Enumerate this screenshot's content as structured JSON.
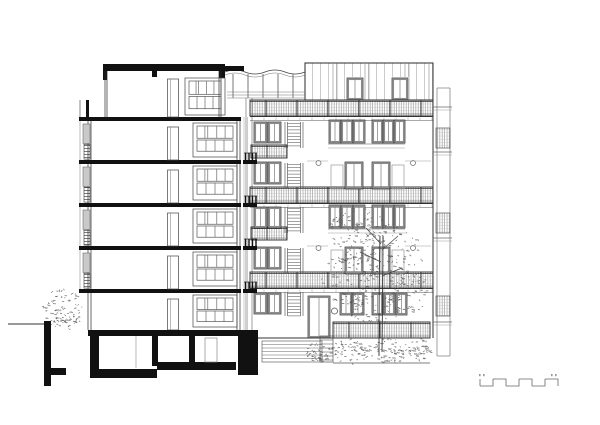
{
  "drawing": {
    "kind": "architectural section and elevation of multi-storey residential building",
    "colors": {
      "line": "#2a2a2a",
      "black": "#111111",
      "light": "#9a9a9a",
      "frame_gray": "#8c8c8c",
      "foliage": "#555555",
      "bg": "#ffffff"
    },
    "section": {
      "slab_x1": 79,
      "slab_x2": 241,
      "slab_h": 4,
      "floor_slabs_y": [
        117,
        160,
        203,
        246,
        289
      ],
      "interiors": [
        {
          "top": 121,
          "bottom": 160
        },
        {
          "top": 164,
          "bottom": 203
        },
        {
          "top": 207,
          "bottom": 246
        },
        {
          "top": 250,
          "bottom": 289
        },
        {
          "top": 293,
          "bottom": 330
        }
      ],
      "door": {
        "x": 167.5,
        "w": 11
      },
      "winwall": {
        "x": 193,
        "w": 44
      },
      "left_wall_x": [
        88,
        91
      ],
      "right_wall_x": [
        237,
        240
      ],
      "left_strip": {
        "panel_x": 83,
        "panel_w": 7,
        "louver_x": 84,
        "louver_w": 6
      },
      "roof": {
        "main": [
          103,
          64,
          121,
          7
        ],
        "left_drop": [
          103,
          64,
          4,
          16
        ],
        "right_drop": [
          219,
          64,
          6,
          14
        ],
        "beam": [
          224,
          66,
          20,
          5
        ],
        "mid_stub": [
          152,
          71,
          5,
          6
        ],
        "parapet": [
          86,
          100,
          3,
          17
        ]
      },
      "penthouse": {
        "wall_left": [
          105,
          107
        ],
        "wall_right": [
          219,
          221
        ],
        "top": 71,
        "floor": 117,
        "door": {
          "x": 167.5,
          "y": 79,
          "w": 11,
          "h": 38
        },
        "winwall": [
          185,
          78,
          40,
          37
        ]
      },
      "stub_slabs_y": [
        160,
        203,
        246,
        289
      ],
      "stub": {
        "x": 243,
        "w": 14
      },
      "ground_band": [
        88,
        330,
        170,
        6
      ],
      "basement_black": [
        [
          90,
          336,
          9,
          35
        ],
        [
          90,
          369,
          67,
          9
        ],
        [
          157,
          362,
          79,
          8
        ],
        [
          152,
          336,
          6,
          30
        ],
        [
          189,
          336,
          6,
          26
        ],
        [
          238,
          336,
          20,
          39
        ]
      ],
      "basement_door": [
        205,
        338,
        12,
        24
      ],
      "basement_line_x": 136
    },
    "site": {
      "ground_line": [
        8,
        324,
        44,
        324
      ],
      "retaining_wall": [
        [
          44,
          321,
          7,
          65
        ],
        [
          51,
          368,
          15,
          7
        ]
      ]
    },
    "elevation": {
      "left_edge_x": [
        246,
        252
      ],
      "right_edge_x": 433,
      "top_y": 63,
      "bottom_y": 338,
      "penthouse": {
        "x1": 305,
        "x2": 433,
        "y1": 63,
        "y2": 100,
        "joints": [
          333,
          337,
          365,
          369,
          405,
          409,
          429
        ],
        "doors": [
          {
            "x": 347,
            "y": 78,
            "w": 16,
            "h": 22
          },
          {
            "x": 392,
            "y": 78,
            "w": 16,
            "h": 22
          }
        ]
      },
      "pergola": {
        "x1": 225,
        "x2": 305,
        "posts": [
          233,
          248,
          263,
          278,
          293
        ],
        "canopy_y": 69,
        "rail_y": [
          92,
          95,
          98
        ]
      },
      "mesh_bands": [
        {
          "x1": 250,
          "x2": 433,
          "y": 100,
          "h": 16
        },
        {
          "x1": 250,
          "x2": 433,
          "y": 187,
          "h": 16
        },
        {
          "x1": 250,
          "x2": 433,
          "y": 272,
          "h": 16
        }
      ],
      "half_bands": [
        {
          "x1": 251,
          "x2": 287,
          "y": 145,
          "h": 13
        },
        {
          "x1": 251,
          "x2": 287,
          "y": 227,
          "h": 13
        }
      ],
      "fence_band": {
        "x1": 333,
        "x2": 430,
        "y": 322,
        "h": 16
      },
      "fascia_y": [
        116.5,
        203.5,
        288.5
      ],
      "duplex_tops": [
        121,
        206
      ],
      "ground_top": 292,
      "entry": {
        "door": [
          308,
          296,
          22,
          42
        ],
        "porthole": [
          334.5,
          311,
          3
        ]
      },
      "ext_stair": {
        "x1": 262,
        "x2": 322,
        "y1": 341,
        "y2": 362
      },
      "step_block": {
        "x1": 320,
        "x2": 333,
        "y1": 336,
        "y2": 362
      },
      "bottom_line_y": 363,
      "side_strip": {
        "x1": 437,
        "x2": 450,
        "top": 88,
        "bottom": 356,
        "ledges_y": [
          107,
          152,
          238,
          322
        ],
        "balconies_y": [
          128,
          213,
          296
        ]
      }
    },
    "trees": {
      "seed": 7,
      "trunk": {
        "x": 381,
        "top": 236,
        "bottom": 356
      },
      "canopy_blobs": [
        {
          "cx": 358,
          "cy": 232,
          "rx": 30,
          "ry": 26,
          "n": 95
        },
        {
          "cx": 392,
          "cy": 255,
          "rx": 32,
          "ry": 30,
          "n": 115
        },
        {
          "cx": 350,
          "cy": 280,
          "rx": 28,
          "ry": 26,
          "n": 95
        },
        {
          "cx": 408,
          "cy": 292,
          "rx": 20,
          "ry": 22,
          "n": 70
        },
        {
          "cx": 372,
          "cy": 308,
          "rx": 30,
          "ry": 16,
          "n": 60
        }
      ],
      "left_bush": {
        "cx": 63,
        "cy": 309,
        "rx": 20,
        "ry": 21,
        "n": 90
      },
      "ground_bushes": [
        {
          "cx": 318,
          "cy": 352,
          "rx": 14,
          "ry": 10,
          "n": 45
        },
        {
          "cx": 352,
          "cy": 351,
          "rx": 20,
          "ry": 12,
          "n": 60
        },
        {
          "cx": 390,
          "cy": 351,
          "rx": 20,
          "ry": 12,
          "n": 60
        },
        {
          "cx": 419,
          "cy": 349,
          "rx": 12,
          "ry": 11,
          "n": 45
        }
      ]
    },
    "scale_bar": {
      "x": 480,
      "y_top": 379,
      "y_bot": 386,
      "step_w": 13,
      "steps": 6
    }
  }
}
